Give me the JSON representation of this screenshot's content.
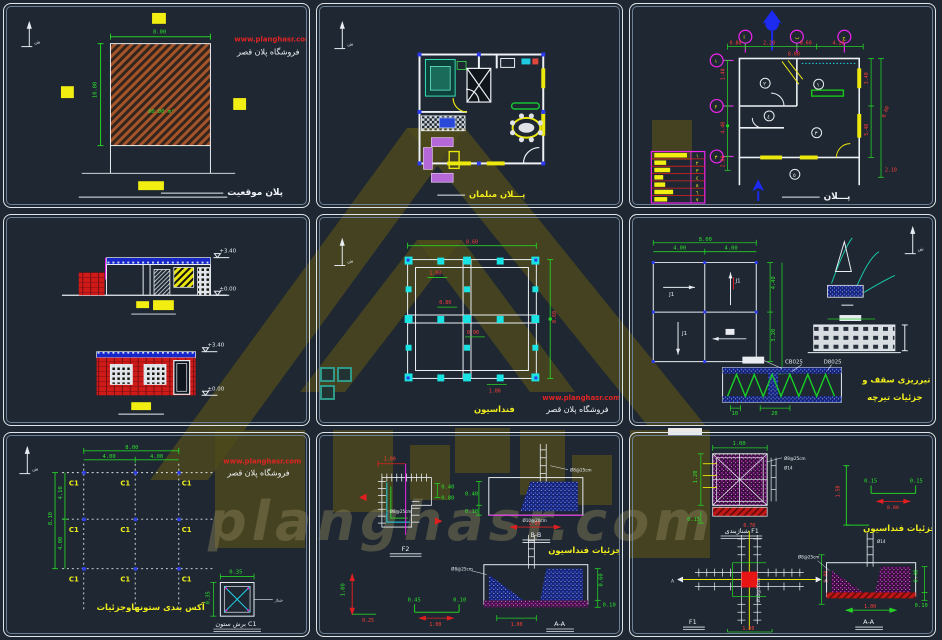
{
  "branding": {
    "url": "www.planghasr.com",
    "shop": "فروشگاه پلان قصر"
  },
  "watermark": {
    "text": "planghasr.com"
  },
  "panels": {
    "site_plan": {
      "label": "پلان موقعیت",
      "area": "80.00 m²",
      "dim_w": "8.00",
      "dim_h": "10.00"
    },
    "furniture_plan": {
      "label": "پـــلان مبلمان"
    },
    "plan": {
      "label": "پـــلان",
      "axis_a": "ا",
      "axis_b": "ب",
      "axis_c": "ج",
      "axis_1": "١",
      "axis_2": "٢",
      "axis_3": "٣",
      "dims_top": [
        "0.80",
        "2.20",
        "0.60",
        "4.10"
      ],
      "dim_top_total": "8.60",
      "dims_left": [
        "1.40",
        "4.40",
        "2.00"
      ],
      "dims_right": [
        "3.40",
        "5.40",
        "2.10"
      ],
      "dim_right_total": "8.60",
      "dim_bottom": "2.10",
      "rooms": [
        "١",
        "٢",
        "٣",
        "٤",
        "٥"
      ],
      "schedule": [
        "١",
        "٢",
        "٣",
        "٤",
        "٥",
        "٦",
        "٧"
      ]
    },
    "elevations": {
      "level_a_top": "+3.40",
      "level_a_base": "±0.00",
      "level_b_top": "+3.40",
      "level_b_base": "±0.00"
    },
    "foundation_plan": {
      "label": "فنداسیون",
      "dim_top": "8.60",
      "dim_right": "8.60",
      "d1": "1.00",
      "d2": "0.80",
      "d3": "0.90",
      "d4": "1.00"
    },
    "joists": {
      "label1": "تیرریزی سقف و",
      "label2": "جزئیات تیرچه",
      "dims_top": [
        "4.00",
        "4.00"
      ],
      "dim_total": "8.00",
      "dims_right": [
        "4.40",
        "3.20"
      ],
      "dim_small": "0.40",
      "tag": "J1",
      "t1": "CB025",
      "t2": "D8025",
      "len1": "10",
      "len2": "20"
    },
    "axes": {
      "label": "آکس بندی ستونهاوجزئیات",
      "tag": "C1",
      "dim_top_total": "8.00",
      "dims_top": [
        "4.00",
        "4.00"
      ],
      "dim_left_total": "8.10",
      "dims_left": [
        "4.10",
        "4.00"
      ],
      "det_w": "0.35",
      "det_h": "0.35",
      "det_note": "شناژ",
      "det_label": "برش ستون C1"
    },
    "fd1": {
      "label": "جزئیات فنداسیون",
      "f2": "F2",
      "bb": "B-B",
      "aa": "A-A",
      "note1": "Ø8@25cm",
      "note2": "Ø10@20cm",
      "d1": "1.00",
      "d2": "0.40",
      "d3": "0.80",
      "d4": "0.40",
      "d5": "0.10",
      "d6": "1.00",
      "d7": "0.60",
      "d8": "0.10",
      "d9": "1.00",
      "d10": "1.00",
      "d11": "0.25",
      "d12": "0.45",
      "d13": "0.10"
    },
    "fd2": {
      "label": "جزئیات فنداسیون",
      "sec": "شناژبندی F1",
      "f1": "F1",
      "aa": "A-A",
      "note1": "Ø8@25cm",
      "note2": "Ø14",
      "note3": "Ø10@20cm",
      "mark": "A",
      "d_top": "1.00",
      "d_left": "1.20",
      "d_strip": "0.15",
      "bar_v": "1.50",
      "bar_h": "0.90",
      "bar_e1": "0.15",
      "bar_e2": "0.15",
      "c_l": "0.70",
      "c_r": "1.00",
      "c_b": "1.00",
      "a1": "0.40",
      "a2": "0.10",
      "a3": "1.00"
    }
  }
}
